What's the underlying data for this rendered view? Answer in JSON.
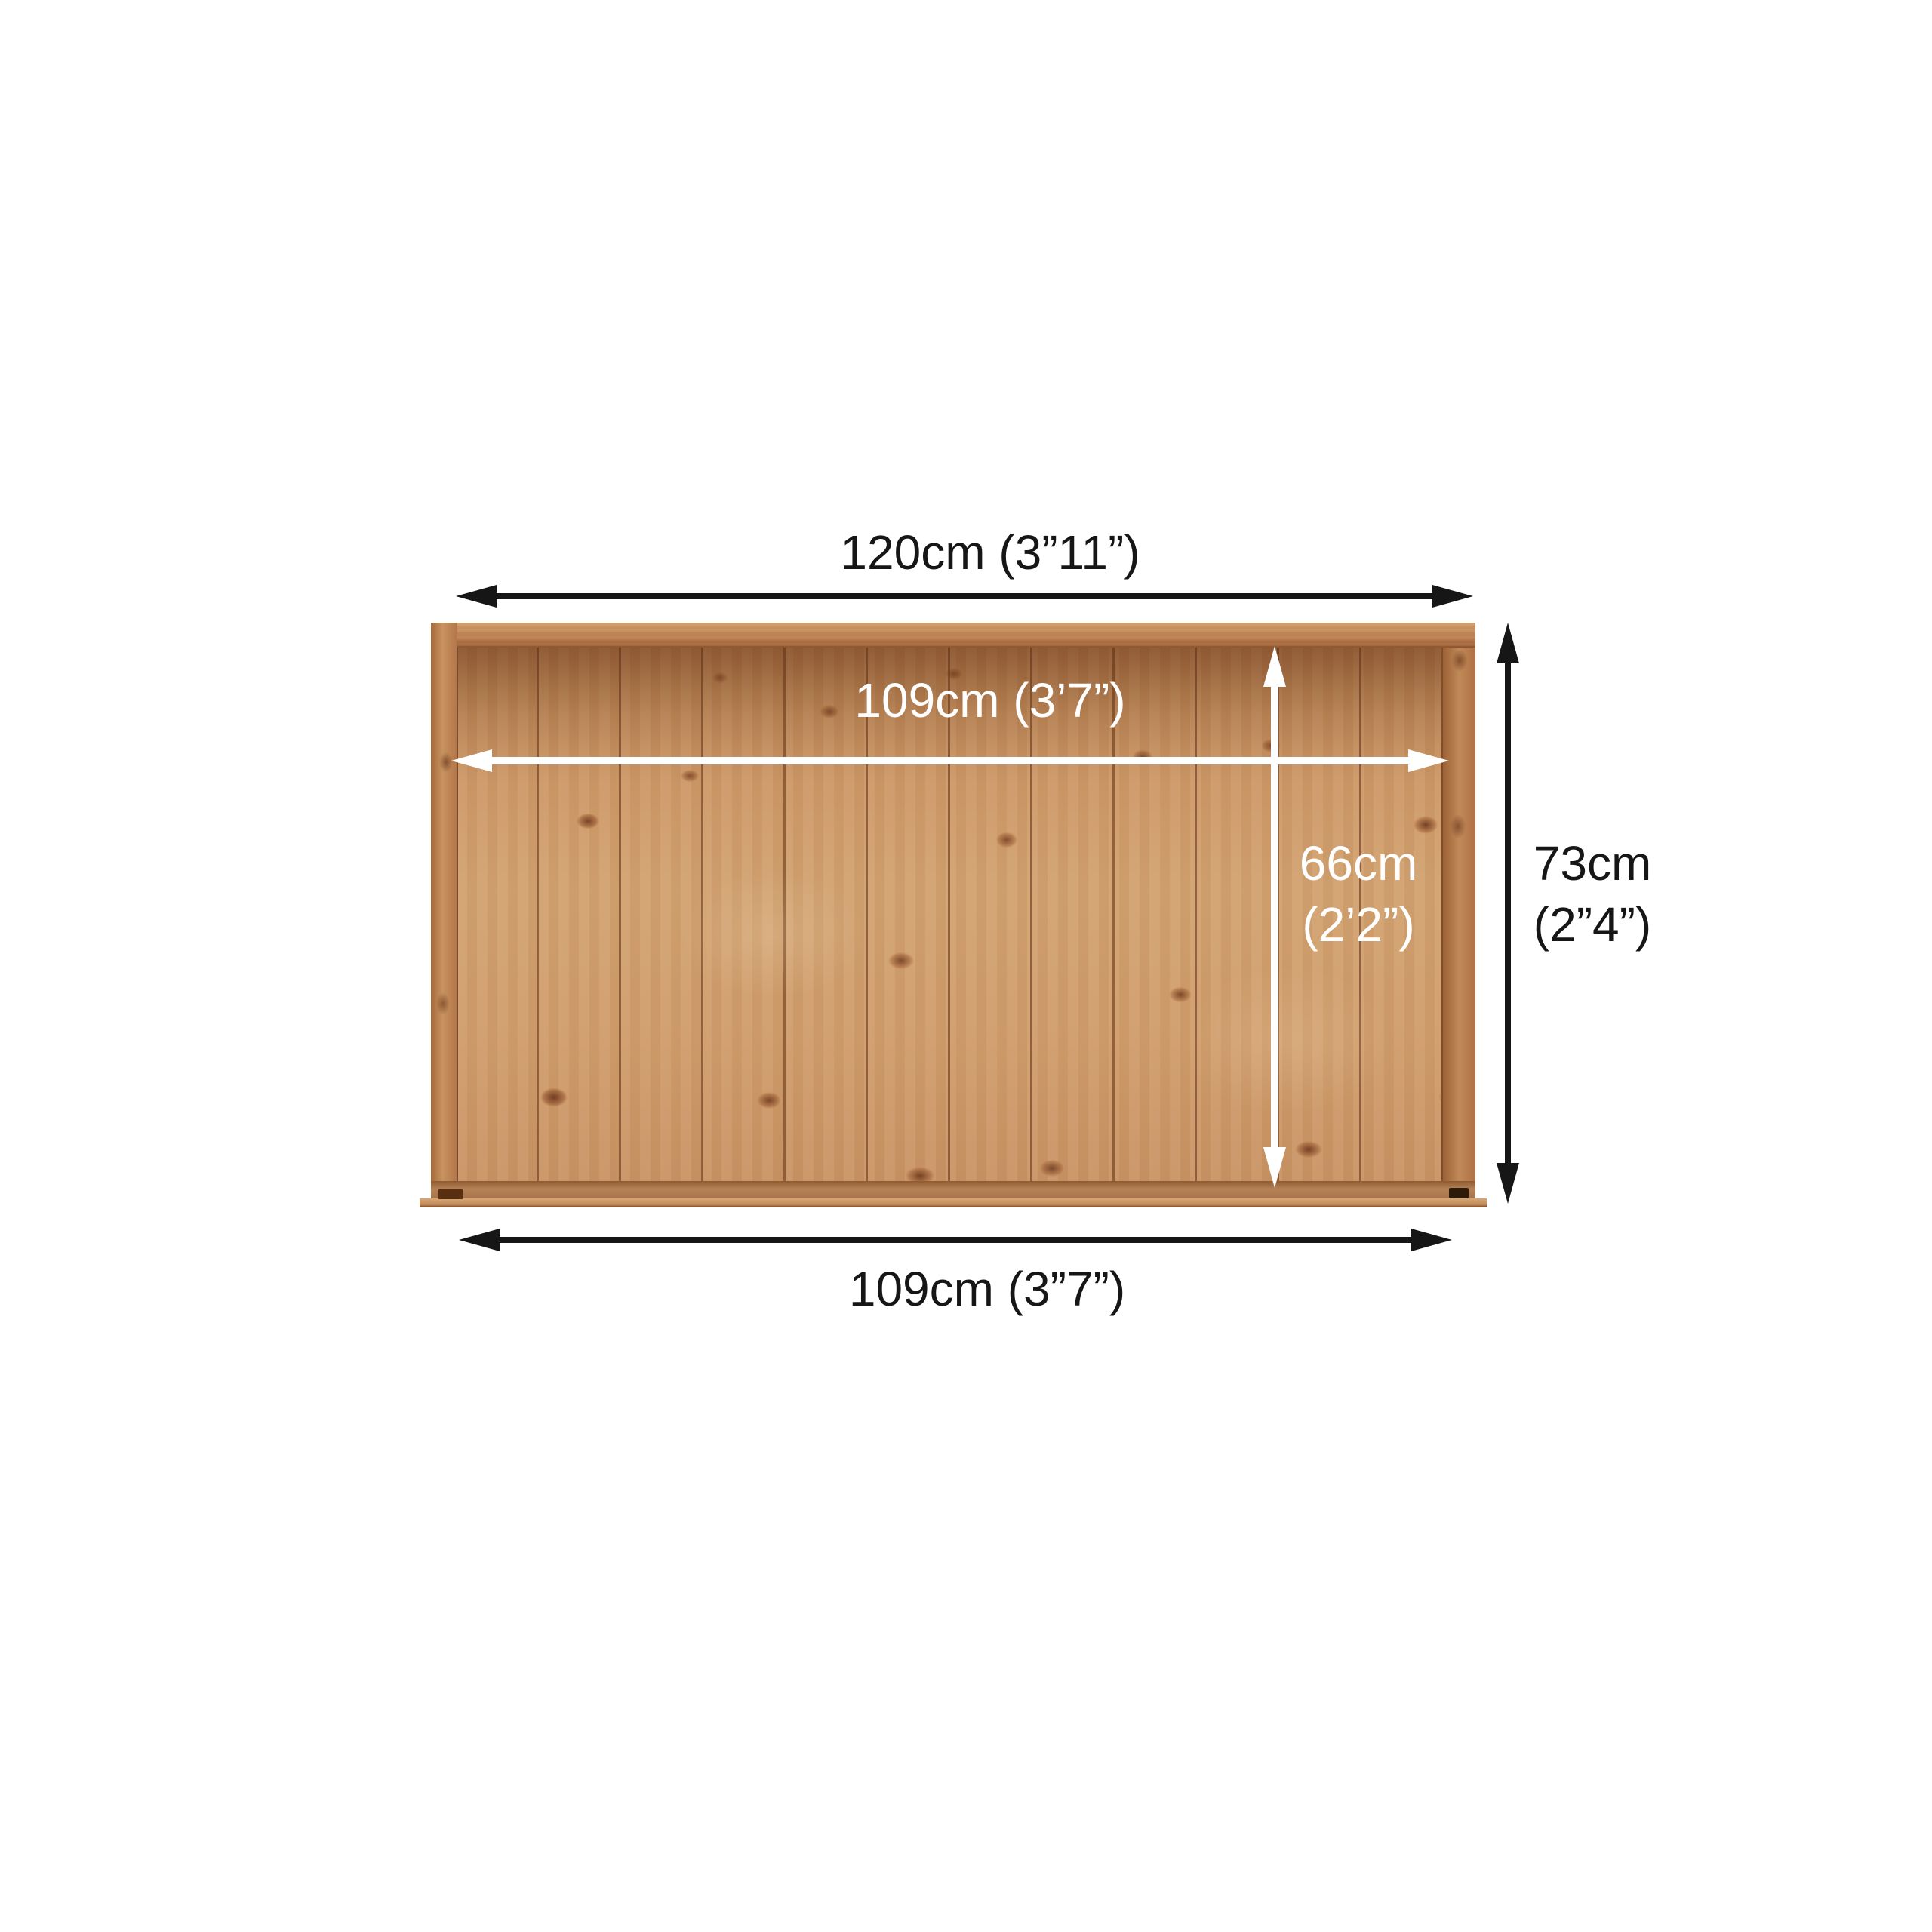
{
  "colors": {
    "background": "#ffffff",
    "dimension-dark": "#161616",
    "dimension-light": "#ffffff",
    "wood-base": "#cd9765",
    "wood-frame": "#b5774a",
    "wood-seam": "#6f3d1f",
    "wood-knot": "#8a4726"
  },
  "dimensions": {
    "outer_width": {
      "label": "120cm (3”11”)"
    },
    "inner_width": {
      "label": "109cm (3’7”)"
    },
    "inner_height": {
      "line1": "66cm",
      "line2": "(2’2”)"
    },
    "outer_height": {
      "line1": "73cm",
      "line2": "(2”4”)"
    },
    "base_width": {
      "label": "109cm (3”7”)"
    }
  }
}
